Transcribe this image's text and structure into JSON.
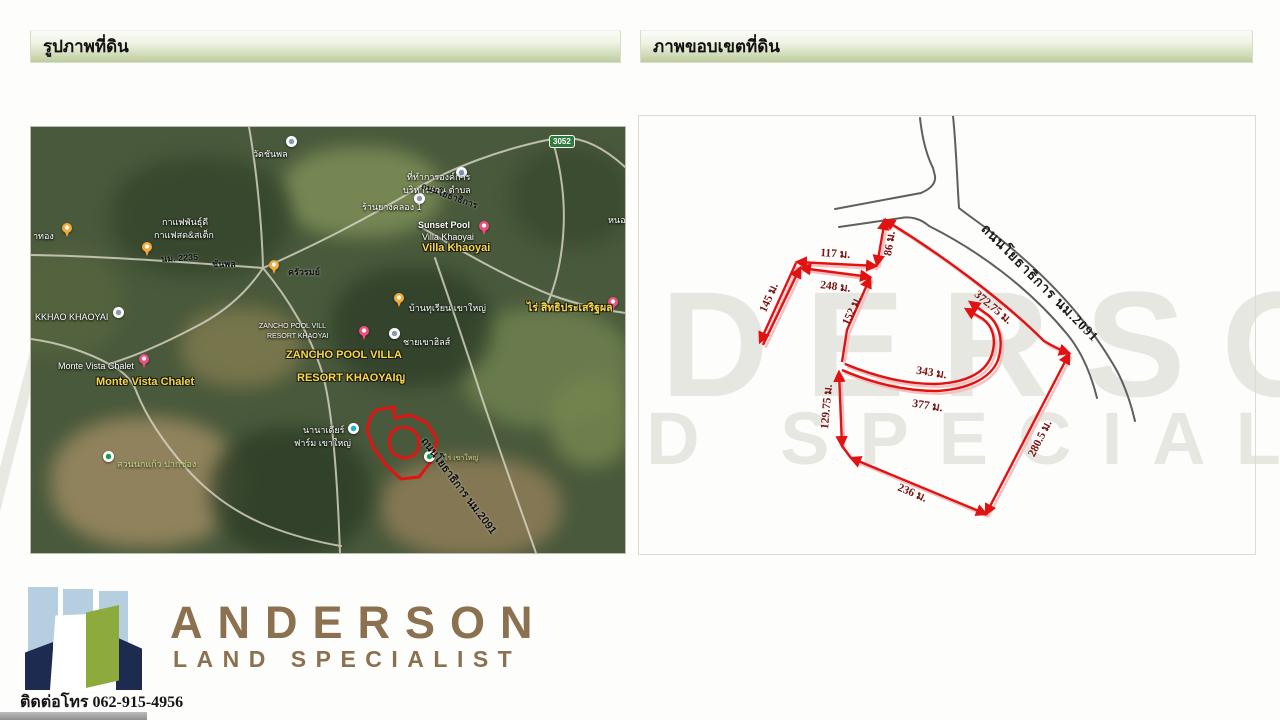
{
  "headers": {
    "left": "รูปภาพที่ดิน",
    "right": "ภาพขอบเขตที่ดิน"
  },
  "watermark": {
    "line1": "ANDERSON",
    "line2": "LAND SPECIALIST"
  },
  "map": {
    "labels": [
      "าทอง",
      "วัดชันพล",
      "กาแฟพันธุ์ดี",
      "กาแฟสด&สเต็ก",
      "นม. 2235",
      "ชันพล",
      "ครัวรมย์",
      "ที่ทำการองค์การ",
      "บริหารส่วน ตำบล",
      "ร้านยางคลอง 1",
      "ถนนโยธาธิการ",
      "Sunset Pool",
      "Villa Khaoyai",
      "Villa Khaoyai",
      "หนองค",
      "ไร่ สิทธิประเสริฐผล",
      "ZANCHO POOL VILL",
      "RESORT KHAOYAI",
      "ชายเขาฮิลส์",
      "ZANCHO POOL VILLA",
      "RESORT KHAOYAIญ",
      "Monte Vista Chalet",
      "Monte Vista Chalet",
      "สวนนกแก้ว ปากช่อง",
      "นานาเดียร์",
      "ฟาร์ม เขาใหญ่",
      "ไร่ เขาใหญ่",
      "ถนนโยธาธิการ นม.2091",
      "KKHAO KHAOYAI",
      "บ้านทุเรียน เขาใหญ่"
    ],
    "shield": "3052"
  },
  "boundary": {
    "measurements": [
      "86 ม.",
      "117 ม.",
      "248 ม.",
      "145 ม.",
      "152 ม.",
      "343 ม.",
      "377 ม.",
      "129.75 ม.",
      "236 ม.",
      "280.5 ม.",
      "372.75 ม."
    ],
    "road_label": "ถนนโยธาธิการ นม.2091"
  },
  "logo": {
    "name": "ANDERSON",
    "tagline": "LAND SPECIALIST",
    "phone_label": "ติดต่อโทร",
    "phone": "062-915-4956"
  },
  "colors": {
    "accent_red": "#e11212",
    "road_gray": "#5f5f5f",
    "header_green": "#bccd9e",
    "logo_brown": "#8b7150",
    "logo_green": "#8dab3c",
    "logo_navy": "#1d2b50",
    "logo_blue": "#b6cfe0"
  }
}
